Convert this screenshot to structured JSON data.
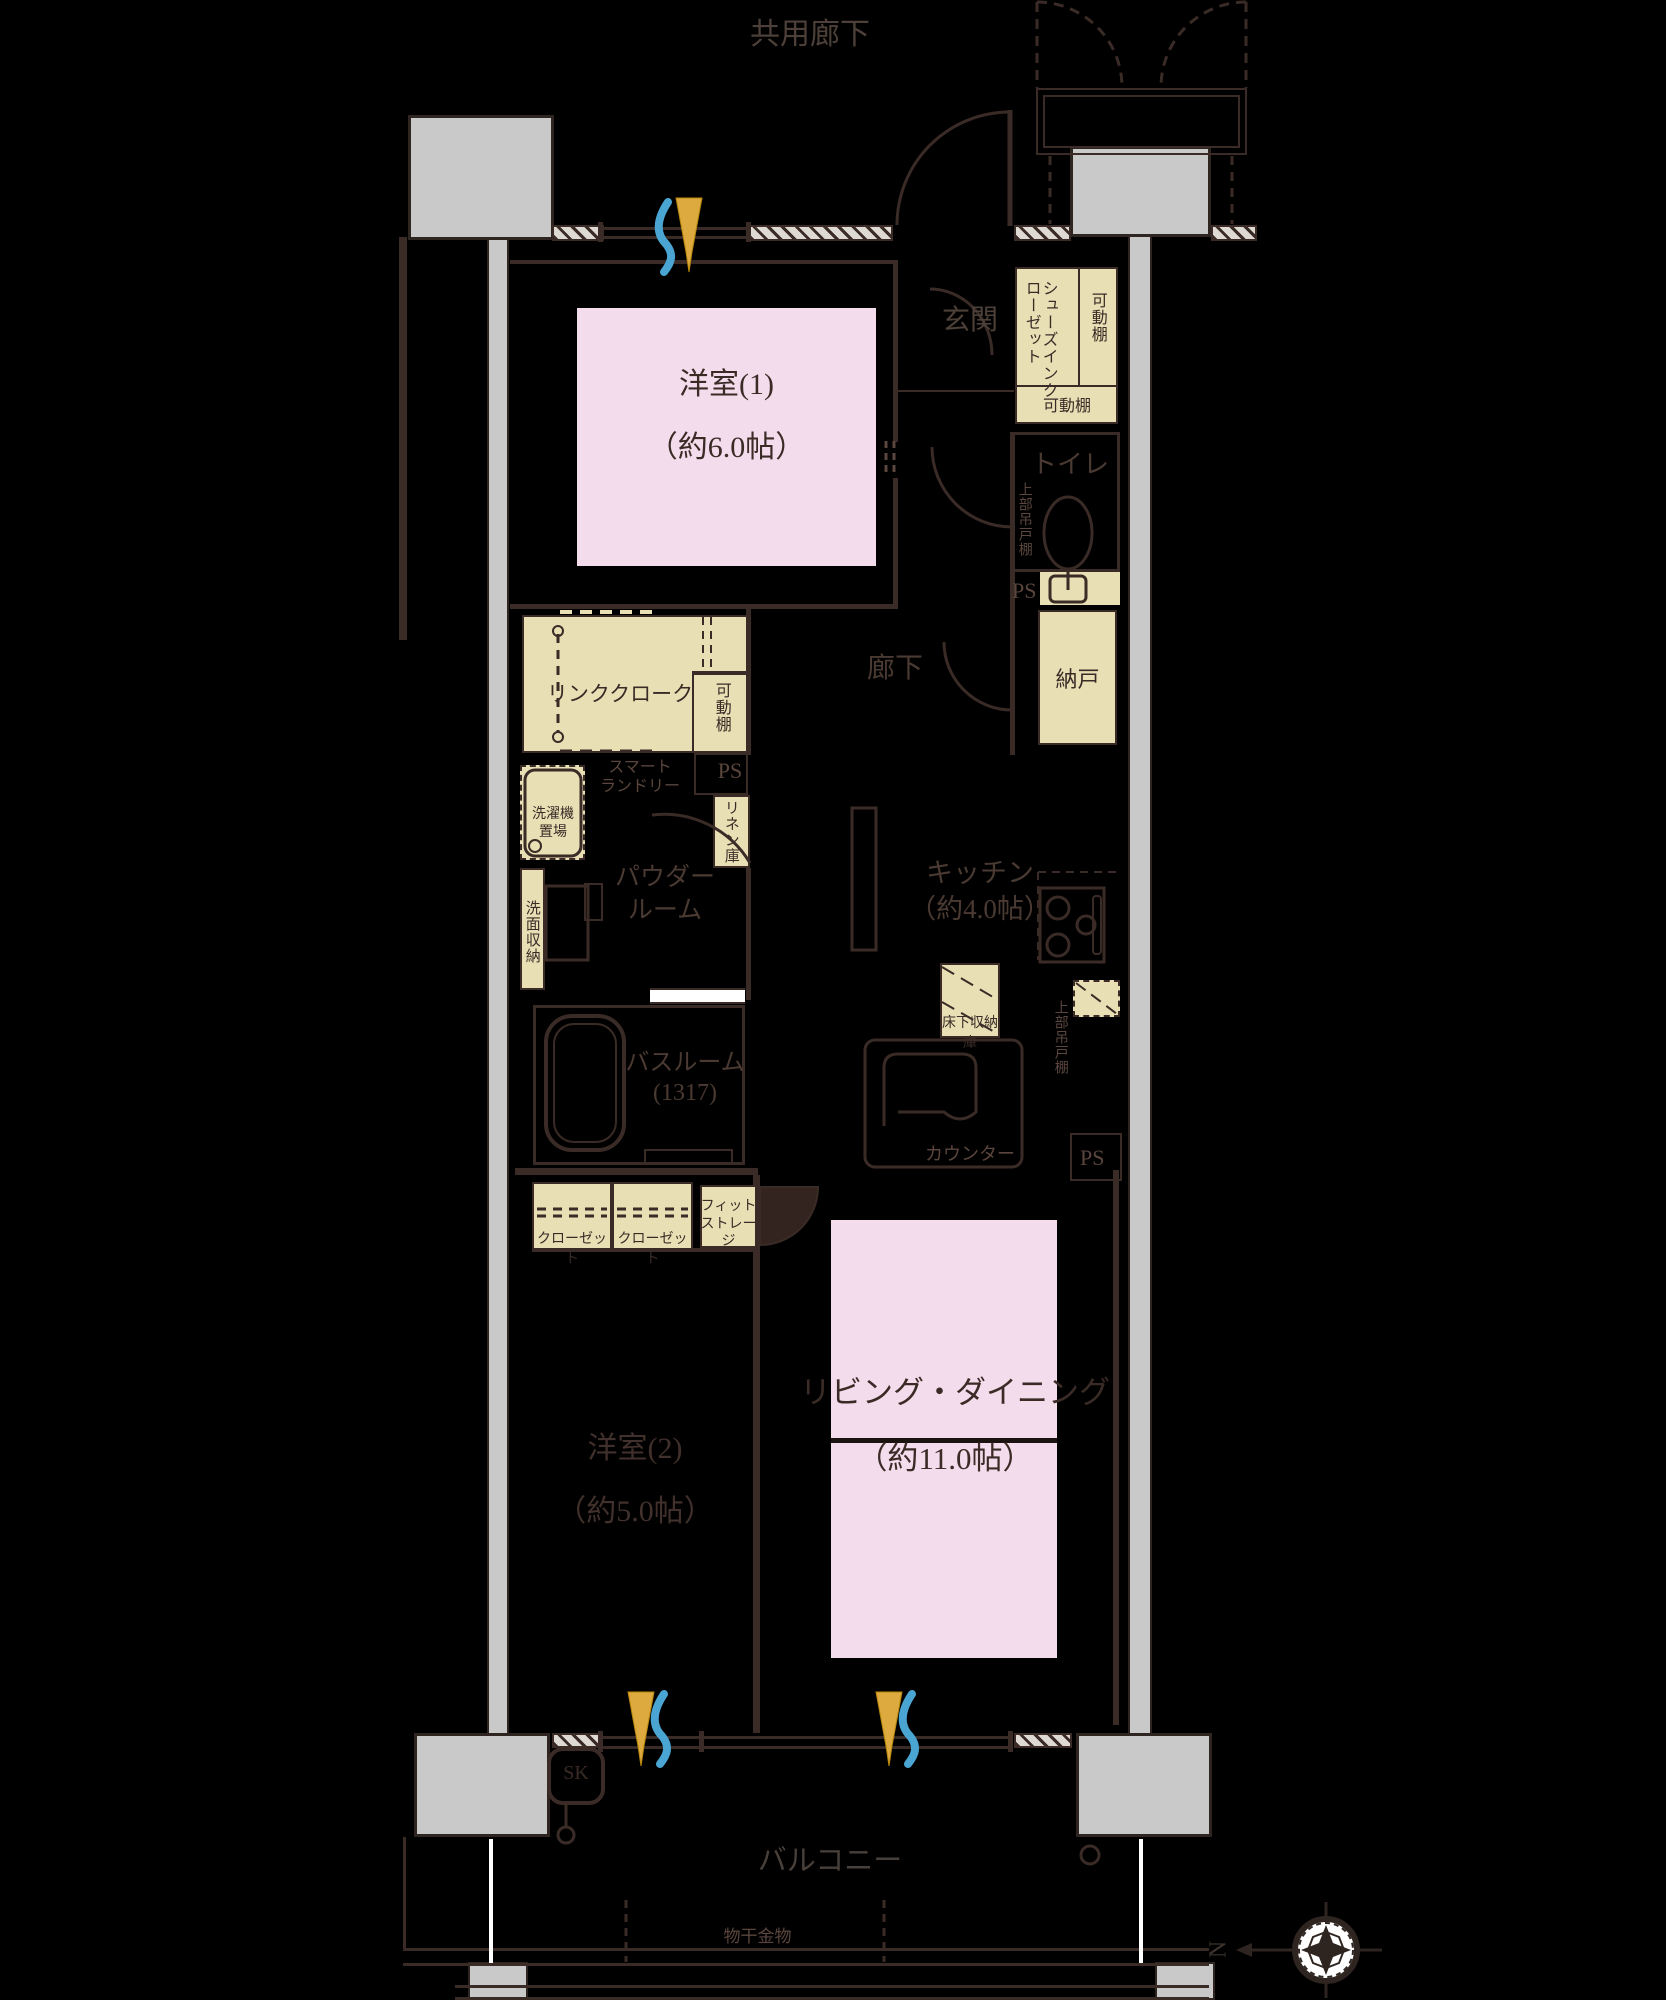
{
  "title": "マンション間取り図 2LDK+納戸",
  "colors": {
    "background": "#000000",
    "line": "#3a2b26",
    "room_pink": "#f3dceb",
    "storage_beige": "#e9dfb5",
    "pillar_gray": "#c9c9c9",
    "breeze_blue": "#4aa5d2",
    "breeze_gold": "#dcaa3e"
  },
  "labels": {
    "common_corridor": "共用廊下",
    "genkan": "玄関",
    "shoes_closet_line1": "シューズイン",
    "shoes_closet_line2": "クローゼット",
    "movable_shelf": "可動棚",
    "toilet": "トイレ",
    "upper_cabinet": "上部吊戸棚",
    "ps": "PS",
    "storage_room": "納戸",
    "corridor": "廊下",
    "room1_name": "洋室(1)",
    "room1_size": "（約6.0帖）",
    "link_cloak": "リンククローク",
    "smart_laundry_line1": "スマート",
    "smart_laundry_line2": "ランドリー",
    "washer_line1": "洗濯機",
    "washer_line2": "置場",
    "linen": "リネン庫",
    "vanity_storage": "洗面収納",
    "powder_line1": "パウダー",
    "powder_line2": "ルーム",
    "bath_name": "バスルーム",
    "bath_size": "(1317)",
    "kitchen_name": "キッチン",
    "kitchen_size": "（約4.0帖）",
    "underfloor_storage": "床下収納庫",
    "counter": "カウンター",
    "closet": "クローゼット",
    "fit_storage_line1": "フィット",
    "fit_storage_line2": "ストレージ",
    "room2_name": "洋室(2)",
    "room2_size": "（約5.0帖）",
    "ld_name": "リビング・ダイニング",
    "ld_size": "（約11.0帖）",
    "balcony": "バルコニー",
    "laundry_hardware": "物干金物",
    "slop_sink": "SK",
    "compass_north": "N"
  }
}
